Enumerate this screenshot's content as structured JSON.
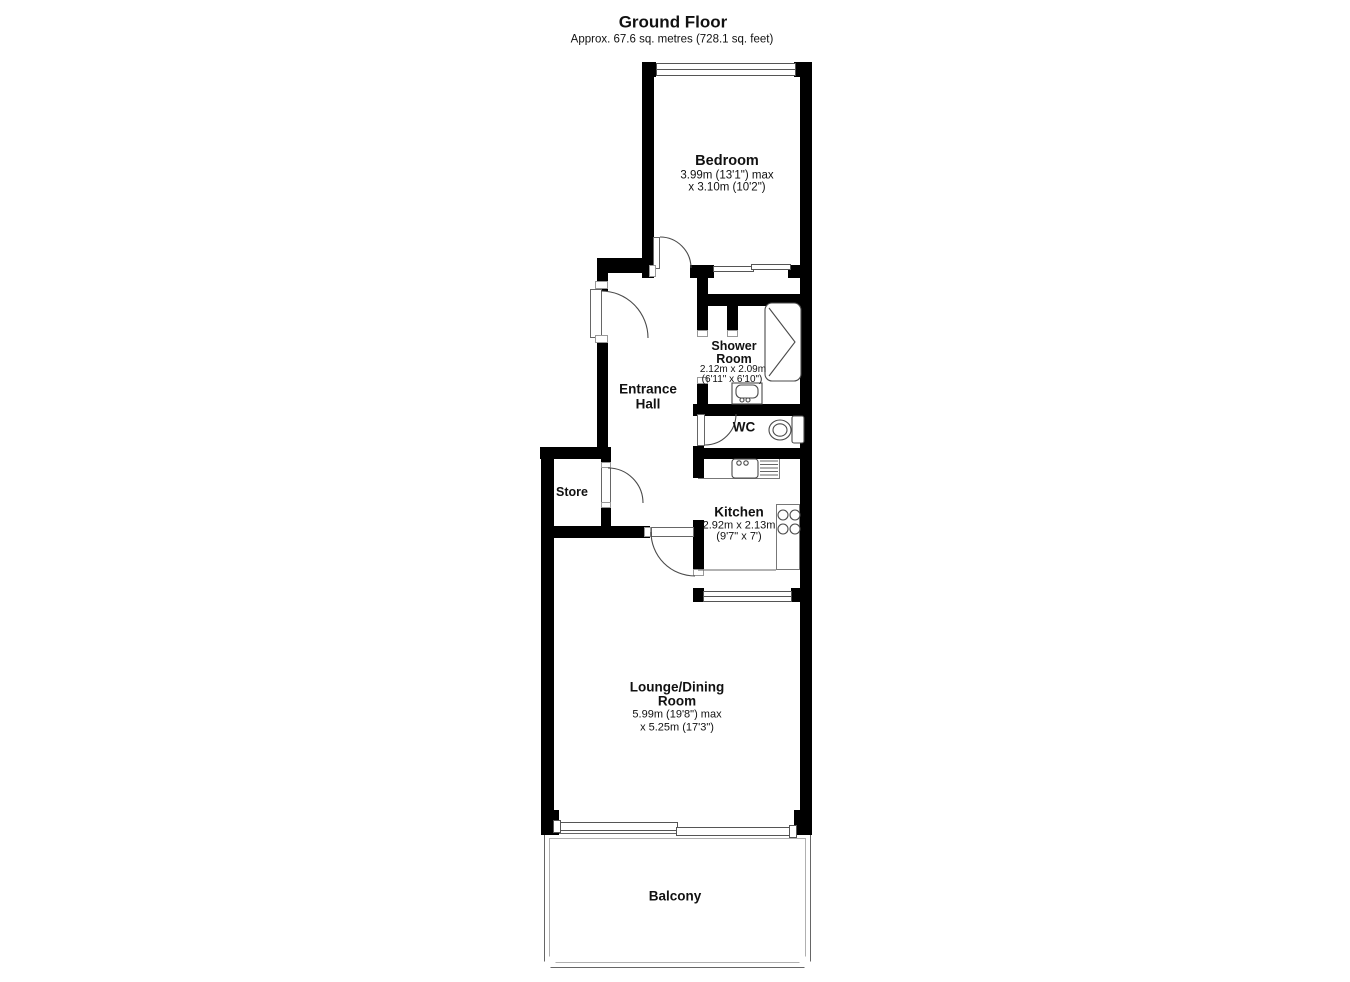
{
  "header": {
    "title": "Ground Floor",
    "subtitle": "Approx. 67.6 sq. metres (728.1 sq. feet)"
  },
  "rooms": {
    "bedroom": {
      "name": "Bedroom",
      "dim1": "3.99m (13'1\") max",
      "dim2": "x 3.10m (10'2\")"
    },
    "shower": {
      "name1": "Shower",
      "name2": "Room",
      "dim1": "2.12m x 2.09m",
      "dim2": "(6'11\" x 6'10\")"
    },
    "hall": {
      "name1": "Entrance",
      "name2": "Hall"
    },
    "wc": {
      "name": "WC"
    },
    "store": {
      "name": "Store"
    },
    "kitchen": {
      "name": "Kitchen",
      "dim1": "2.92m x 2.13m",
      "dim2": "(9'7\" x 7')"
    },
    "lounge": {
      "name1": "Lounge/Dining",
      "name2": "Room",
      "dim1": "5.99m (19'8\") max",
      "dim2": "x 5.25m (17'3\")"
    },
    "balcony": {
      "name": "Balcony"
    }
  },
  "fixtures": {
    "shower_enclosure": "shower-enclosure-icon",
    "washbasin": "washbasin-icon",
    "toilet": "toilet-icon",
    "kitchen_sink": "kitchen-sink-icon",
    "drainer": "drainer-icon",
    "hob": "hob-icon",
    "wardrobe": "wardrobe-sliding-doors",
    "window": "window-glyph",
    "patio_door": "sliding-patio-door",
    "door_swing": "door-swing-arc"
  },
  "colors": {
    "wall": "#000000",
    "fixture_line": "#4a4a4a",
    "thin_line": "#8a8a8a",
    "text": "#111111",
    "background": "#ffffff"
  }
}
